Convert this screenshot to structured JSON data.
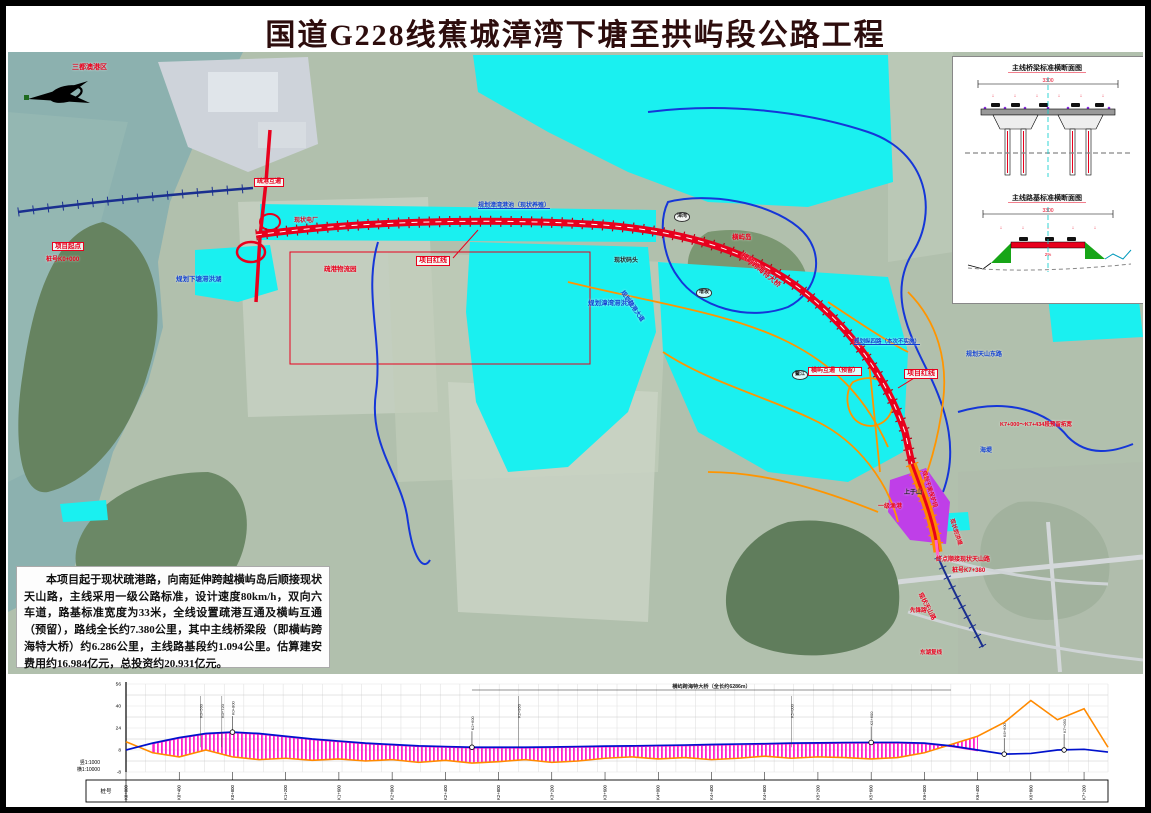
{
  "page": {
    "title": "国道G228线蕉城漳湾下塘至拱屿段公路工程"
  },
  "colors": {
    "route_red": "#e8001d",
    "water_cyan": "#00efef",
    "planned_orange": "#ff9500",
    "boundary_blue": "#1536d8",
    "label_blue": "#1140d0",
    "purple_zone": "#bf3fe8",
    "profile_magenta": "#ff22cc",
    "design_blue": "#0011cc",
    "ground_orange": "#ff8a00"
  },
  "description": {
    "text": "本项目起于现状疏港路，向南延伸跨越横屿岛后顺接现状天山路，主线采用一级公路标准，设计速度80km/h，双向六车道，路基标准宽度为33米，全线设置疏港互通及横屿互通（预留），路线全长约7.380公里，其中主线桥梁段（即横屿跨海特大桥）约6.286公里，主线路基段约1.094公里。估算建安费用约16.984亿元，总投资约20.931亿元。"
  },
  "inset": {
    "bridge_section_title": "主线桥梁标准横断面图",
    "bridge_dim": "3300",
    "roadbed_section_title": "主线路基标准横断面图",
    "roadbed_dim": "3300",
    "slope_note": "2%"
  },
  "map": {
    "labels": [
      {
        "t": "三都澳港区",
        "x": 64,
        "y": 12,
        "c": "#e8001d",
        "fs": 7
      },
      {
        "t": "项目起点",
        "x": 44,
        "y": 190,
        "c": "#e8001d",
        "fs": 6.5,
        "box": 1
      },
      {
        "t": "桩号K0+000",
        "x": 38,
        "y": 205,
        "c": "#e8001d",
        "fs": 6
      },
      {
        "t": "疏港互通",
        "x": 246,
        "y": 126,
        "c": "#e8001d",
        "fs": 6,
        "box": 1
      },
      {
        "t": "现状电厂",
        "x": 286,
        "y": 166,
        "c": "#e8001d",
        "fs": 6
      },
      {
        "t": "疏港物流园",
        "x": 316,
        "y": 214,
        "c": "#e8001d",
        "fs": 6.5
      },
      {
        "t": "规划下塘滞洪湖",
        "x": 168,
        "y": 224,
        "c": "#1140d0",
        "fs": 6.5
      },
      {
        "t": "项目红线",
        "x": 408,
        "y": 204,
        "c": "#e8001d",
        "fs": 7,
        "box": 1
      },
      {
        "t": "规划漳湾港池（现状养殖）",
        "x": 470,
        "y": 151,
        "c": "#1140d0",
        "fs": 6,
        "ul": 1
      },
      {
        "t": "现状码头",
        "x": 606,
        "y": 206,
        "c": "#222",
        "fs": 6
      },
      {
        "t": "横屿岛",
        "x": 724,
        "y": 182,
        "c": "#e8001d",
        "fs": 6.5
      },
      {
        "t": "规划漳湾滞洪湖",
        "x": 580,
        "y": 248,
        "c": "#1140d0",
        "fs": 6.5
      },
      {
        "t": "横屿跨海特大桥",
        "x": 736,
        "y": 200,
        "c": "#e8001d",
        "fs": 7,
        "rot": 40
      },
      {
        "t": "规划纵四路（本次不实施）",
        "x": 846,
        "y": 287,
        "c": "#1140d0",
        "fs": 5.5,
        "ul": 1
      },
      {
        "t": "横屿互通（预留）",
        "x": 800,
        "y": 315,
        "c": "#e8001d",
        "fs": 6,
        "box": 1
      },
      {
        "t": "项目红线",
        "x": 896,
        "y": 317,
        "c": "#e8001d",
        "fs": 7,
        "box": 1
      },
      {
        "t": "规划天山东路",
        "x": 958,
        "y": 300,
        "c": "#1140d0",
        "fs": 6
      },
      {
        "t": "K7+000～K7+434段预留拓宽",
        "x": 992,
        "y": 370,
        "c": "#e8001d",
        "fs": 5.5
      },
      {
        "t": "上于山",
        "x": 896,
        "y": 438,
        "c": "#222",
        "fs": 6
      },
      {
        "t": "海堤",
        "x": 972,
        "y": 396,
        "c": "#1140d0",
        "fs": 6
      },
      {
        "t": "一级渔港",
        "x": 870,
        "y": 452,
        "c": "#e8001d",
        "fs": 6
      },
      {
        "t": "规划干渠保护段",
        "x": 918,
        "y": 418,
        "c": "#e8001d",
        "fs": 5.5,
        "rot": 72
      },
      {
        "t": "现状防洪堤",
        "x": 946,
        "y": 466,
        "c": "#e8001d",
        "fs": 5.5,
        "rot": 72
      },
      {
        "t": "终点顺接现状天山路",
        "x": 928,
        "y": 505,
        "c": "#e8001d",
        "fs": 6
      },
      {
        "t": "桩号K7+380",
        "x": 944,
        "y": 516,
        "c": "#e8001d",
        "fs": 6
      },
      {
        "t": "现状天山路",
        "x": 914,
        "y": 540,
        "c": "#e8001d",
        "fs": 6,
        "rot": 62
      },
      {
        "t": "先锋路",
        "x": 902,
        "y": 556,
        "c": "#e8001d",
        "fs": 5.5
      },
      {
        "t": "东湖复线",
        "x": 912,
        "y": 598,
        "c": "#e8001d",
        "fs": 5.5
      },
      {
        "t": "规划疏港大道",
        "x": 616,
        "y": 238,
        "c": "#1140d0",
        "fs": 6,
        "rot": 55
      },
      {
        "t": "漳湾",
        "x": 666,
        "y": 160,
        "c": "#222",
        "fs": 5,
        "circ": 1
      },
      {
        "t": "增坂",
        "x": 688,
        "y": 236,
        "c": "#222",
        "fs": 5,
        "circ": 1
      },
      {
        "t": "鳌江",
        "x": 784,
        "y": 318,
        "c": "#222",
        "fs": 5,
        "circ": 1
      }
    ]
  },
  "profile": {
    "scale_v": "竖1:1000",
    "scale_h": "横1:10000",
    "row_label": "桩号"
  },
  "chart_data": {
    "type": "line",
    "title": "主线纵断面",
    "xlabel": "里程桩号",
    "ylabel": "高程(m)",
    "x_km": [
      0,
      0.2,
      0.4,
      0.6,
      0.8,
      1.0,
      1.2,
      1.4,
      1.6,
      1.8,
      2.0,
      2.2,
      2.4,
      2.6,
      2.8,
      3.0,
      3.2,
      3.4,
      3.6,
      3.8,
      4.0,
      4.2,
      4.4,
      4.6,
      4.8,
      5.0,
      5.2,
      5.4,
      5.6,
      5.8,
      6.0,
      6.2,
      6.4,
      6.6,
      6.8,
      7.0,
      7.2,
      7.38
    ],
    "series": [
      {
        "name": "设计线",
        "color": "#0011cc",
        "values": [
          8,
          13,
          17,
          20,
          21,
          20,
          18,
          16,
          14.5,
          13,
          12,
          11,
          10.5,
          10,
          10,
          10,
          10.2,
          10.5,
          10.8,
          11,
          11.3,
          11.6,
          12,
          12.3,
          12.6,
          13,
          13.2,
          13.4,
          13.5,
          13.5,
          13,
          11,
          8,
          5,
          5.5,
          8,
          8.5,
          6.5
        ]
      },
      {
        "name": "地面线",
        "color": "#ff8a00",
        "values": [
          14,
          6,
          3,
          8,
          3,
          1,
          2,
          0.5,
          1.5,
          0,
          1,
          -1,
          0.5,
          -1.5,
          -0.5,
          1,
          -1,
          0,
          2,
          3,
          1.5,
          2.5,
          1,
          2,
          3.5,
          2,
          3,
          2.5,
          1.5,
          2.5,
          6,
          12,
          18,
          28,
          44,
          30,
          38,
          10
        ]
      }
    ],
    "ylim": [
      -8,
      56
    ],
    "yticks": [
      56,
      40,
      24,
      8,
      -8
    ],
    "grid": true,
    "bridge_span_km": [
      0.15,
      6.44
    ],
    "bridge_note": "横屿跨海特大桥（全长约6286m）",
    "stake_labels": [
      "K0+000",
      "K0+400",
      "K0+800",
      "K1+200",
      "K1+600",
      "K2+000",
      "K2+400",
      "K2+800",
      "K3+200",
      "K3+600",
      "K4+000",
      "K4+400",
      "K4+800",
      "K5+200",
      "K5+600",
      "K6+000",
      "K6+400",
      "K6+800",
      "K7+200"
    ],
    "vc_markers": [
      {
        "km": 0.8,
        "label": "K0+800"
      },
      {
        "km": 2.6,
        "label": "K2+600"
      },
      {
        "km": 5.6,
        "label": "K5+600"
      },
      {
        "km": 6.6,
        "label": "K6+600"
      },
      {
        "km": 7.05,
        "label": "K7+050"
      }
    ],
    "annotations": [
      {
        "km": 0.56,
        "t": "K0+560"
      },
      {
        "km": 0.72,
        "t": "K0+720"
      },
      {
        "km": 2.95,
        "t": "K2+950"
      },
      {
        "km": 5.0,
        "t": "K5+000"
      }
    ]
  }
}
